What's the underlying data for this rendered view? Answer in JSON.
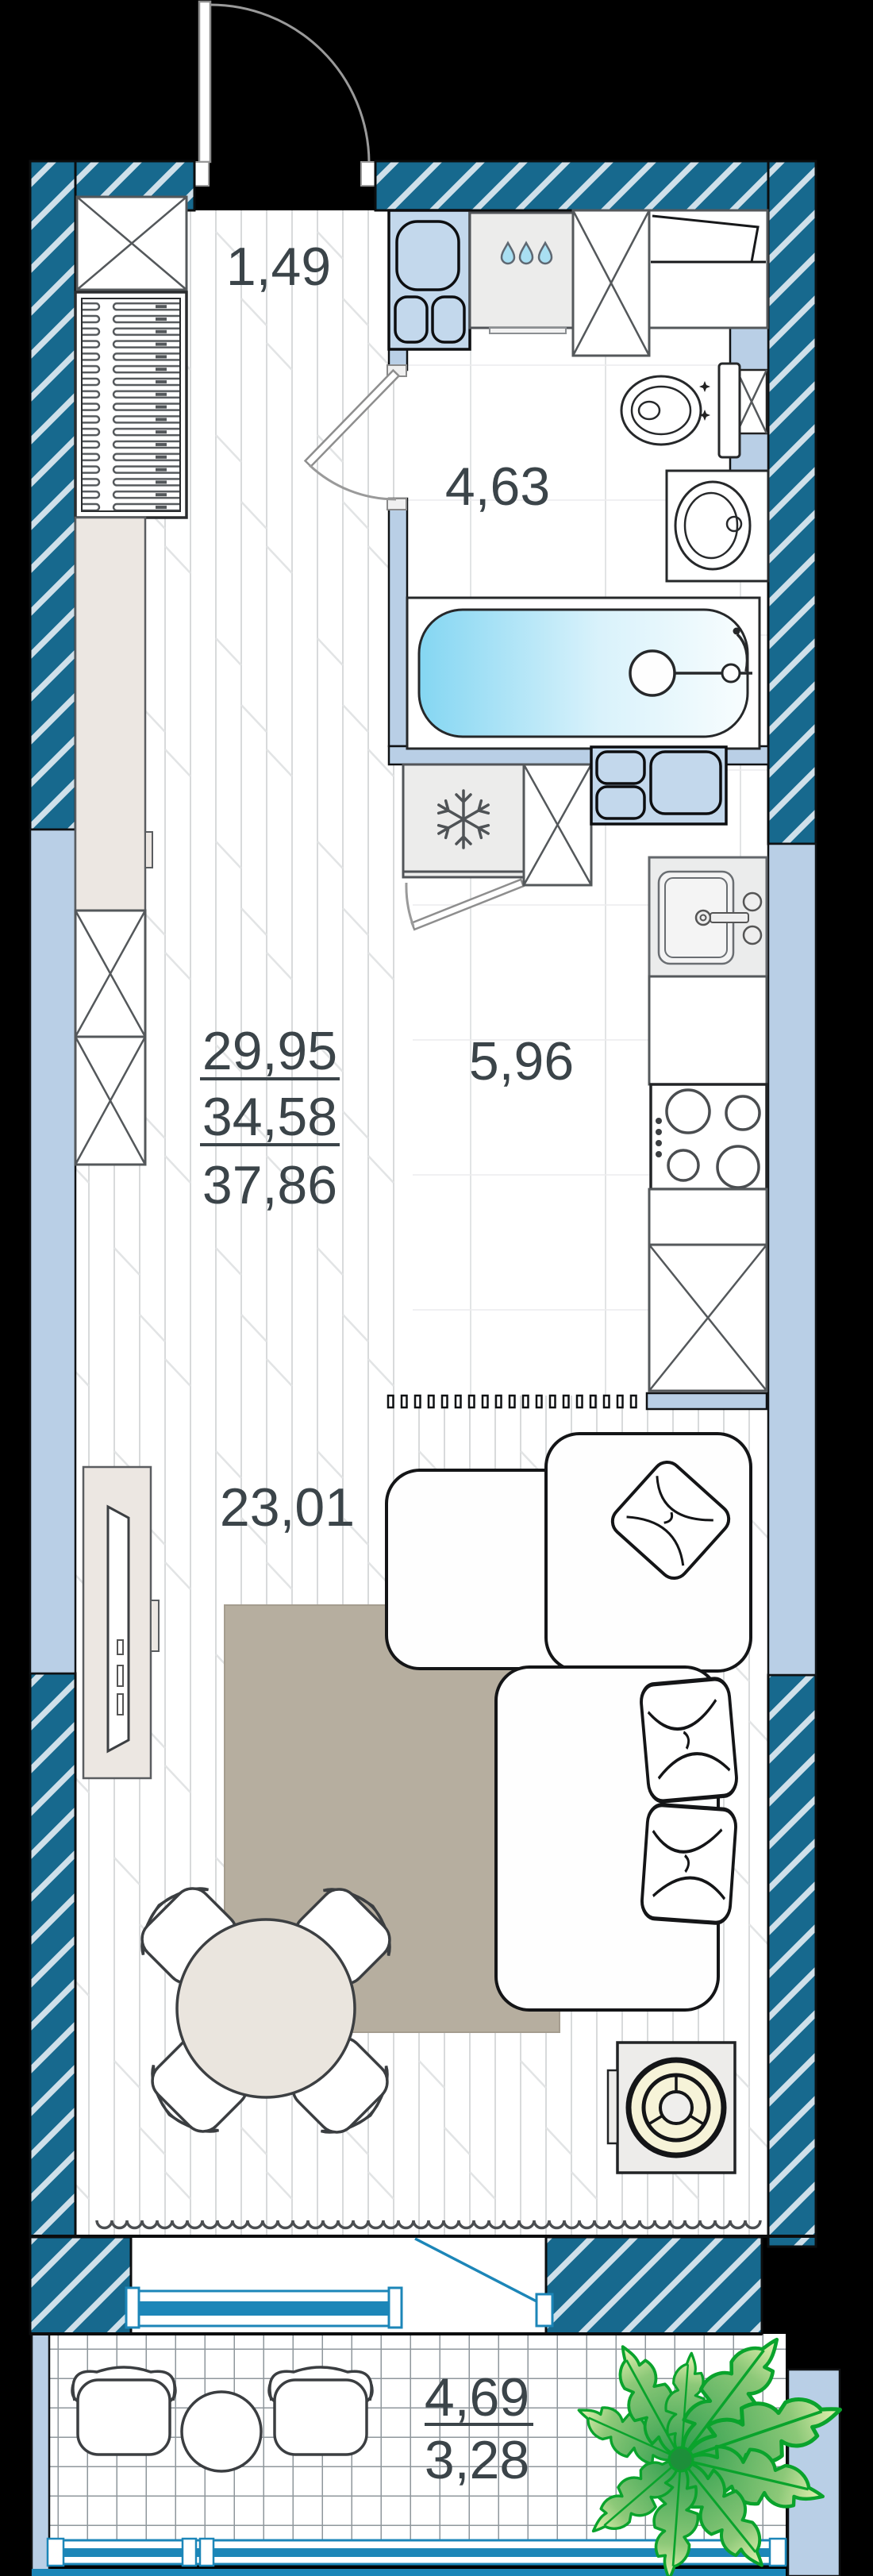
{
  "plan": {
    "title": "studio-apartment-floor-plan",
    "areas": {
      "hall": "1,49",
      "bathroom": "4,63",
      "kitchen": "5,96",
      "living": "23,01",
      "total_stack": [
        "29,95",
        "34,58",
        "37,86"
      ],
      "balcony_stack": [
        "4,69",
        "3,28"
      ]
    },
    "colors": {
      "wall_teal": "#17698E",
      "wall_hatch": "#CFE0EA",
      "partition_blue": "#B9CFE6",
      "fixture_blue": "#C3D8EC",
      "glazing_blue": "#1C86B8",
      "water_drop": "#A9DFF2",
      "tub_water": "#84D6F2",
      "rug": "#B6AE9F",
      "wood_beige": "#ECE7E2",
      "plant_green": "#12A52F",
      "label_text": "#3B4449",
      "background": "#000000"
    }
  }
}
